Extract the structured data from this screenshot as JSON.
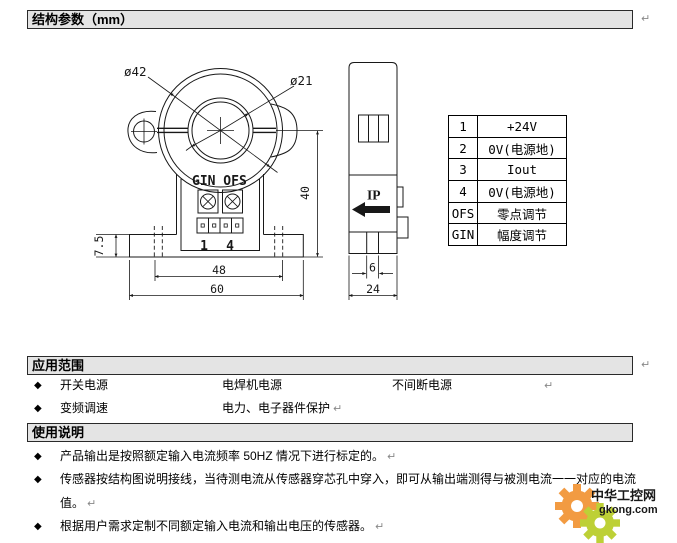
{
  "marks": {
    "pilcrow": "↵"
  },
  "sections": {
    "structure_title": "结构参数（mm）",
    "application_title": "应用范围",
    "usage_title": "使用说明"
  },
  "drawing": {
    "front": {
      "dia_outer": "ø42",
      "dia_inner": "ø21",
      "trim_label": "GIN OFS",
      "pin_first": "1",
      "pin_last": "4",
      "dim_flange_height": "7.5",
      "dim_hole_span": "48",
      "dim_overall_width": "60",
      "dim_overall_height": "40"
    },
    "side": {
      "current_label": "IP",
      "dim_pin_width": "6",
      "dim_depth": "24"
    }
  },
  "pin_table": {
    "rows": [
      {
        "pin": "1",
        "desc": "+24V"
      },
      {
        "pin": "2",
        "desc": "0V(电源地)"
      },
      {
        "pin": "3",
        "desc": "Iout"
      },
      {
        "pin": "4",
        "desc": "0V(电源地)"
      },
      {
        "pin": "OFS",
        "desc": "零点调节"
      },
      {
        "pin": "GIN",
        "desc": "幅度调节"
      }
    ]
  },
  "application": {
    "bullet_char": "◆",
    "row1": {
      "item1": "开关电源",
      "item2": "电焊机电源",
      "item3": "不间断电源"
    },
    "row2": {
      "item1": "变频调速",
      "item2": "电力、电子器件保护"
    }
  },
  "usage": {
    "bullet_char": "◆",
    "line1": "产品输出是按照额定输入电流频率 50HZ 情况下进行标定的。",
    "line2": "传感器按结构图说明接线，当待测电流从传感器穿芯孔中穿入，即可从输出端测得与被测电流一一对应的电流",
    "line2_cont": "值。",
    "line3": "根据用户需求定制不同额定输入电流和输出电压的传感器。"
  },
  "watermark": {
    "site_name": "中华工控网",
    "site_url": "gkong.com",
    "orange": "#f29b42",
    "green": "#bdd036",
    "name_color": "#f07a1d",
    "url_color": "#8f8f8f"
  }
}
